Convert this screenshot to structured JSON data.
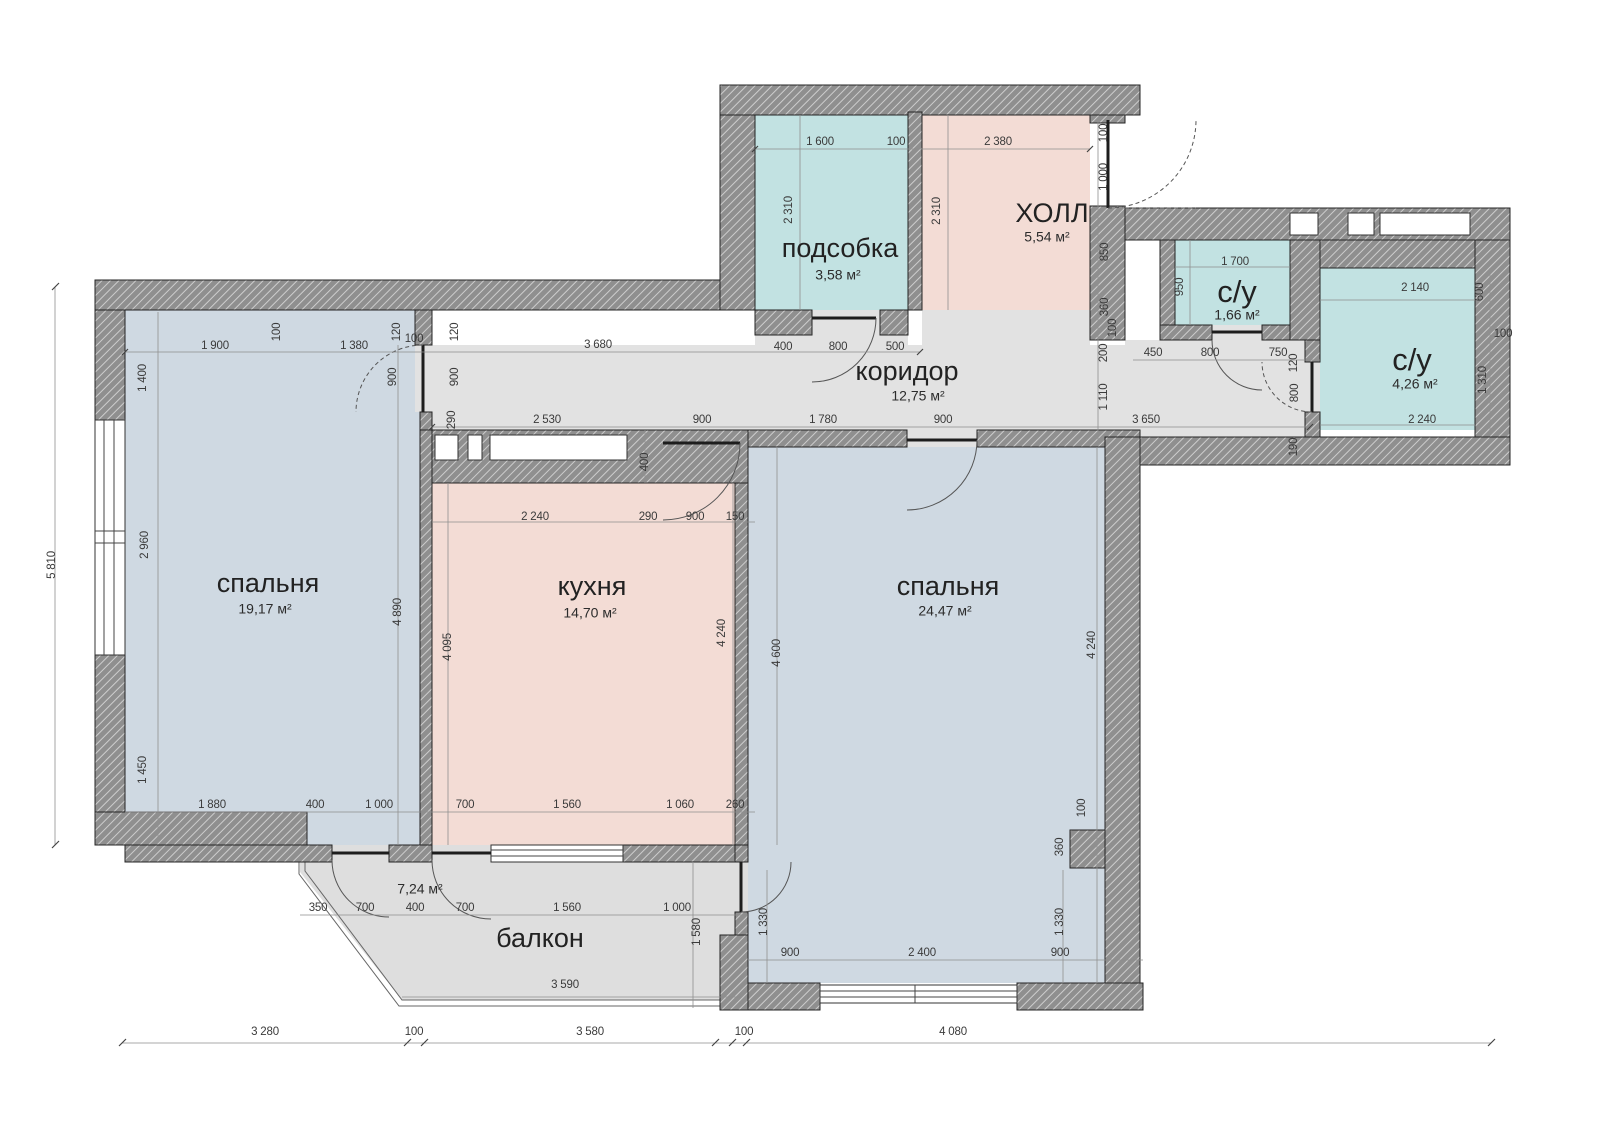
{
  "plan_title": "apartment-floor-plan",
  "colors": {
    "wall": "#8f8f8f",
    "room_blue": "#cfd9e2",
    "room_pink": "#f3dcd5",
    "room_teal": "#c2e2e2",
    "room_gray": "#e2e2e2",
    "balcony_gray": "#dedede"
  },
  "rooms": {
    "bedroom_left": {
      "name": "спальня",
      "area": "19,17 м²"
    },
    "kitchen": {
      "name": "кухня",
      "area": "14,70 м²"
    },
    "bedroom_right": {
      "name": "спальня",
      "area": "24,47 м²"
    },
    "corridor": {
      "name": "коридор",
      "area": "12,75 м²"
    },
    "utility": {
      "name": "подсобка",
      "area": "3,58 м²"
    },
    "hall": {
      "name": "ХОЛЛ",
      "area": "5,54 м²"
    },
    "bathroom_small": {
      "name": "с/у",
      "area": "1,66 м²"
    },
    "bathroom_large": {
      "name": "с/у",
      "area": "4,26 м²"
    },
    "balcony": {
      "name": "балкон",
      "area": "7,24 м²"
    }
  },
  "dimensions": [
    {
      "text": "1 600",
      "x": 820,
      "y": 142,
      "v": false
    },
    {
      "text": "100",
      "x": 896,
      "y": 142,
      "v": false
    },
    {
      "text": "2 380",
      "x": 998,
      "y": 142,
      "v": false
    },
    {
      "text": "2 310",
      "x": 789,
      "y": 210,
      "v": true
    },
    {
      "text": "2 310",
      "x": 937,
      "y": 211,
      "v": true
    },
    {
      "text": "100",
      "x": 1104,
      "y": 133,
      "v": true
    },
    {
      "text": "1 000",
      "x": 1104,
      "y": 177,
      "v": true
    },
    {
      "text": "850",
      "x": 1105,
      "y": 252,
      "v": true
    },
    {
      "text": "360",
      "x": 1105,
      "y": 307,
      "v": true
    },
    {
      "text": "100",
      "x": 1113,
      "y": 328,
      "v": true
    },
    {
      "text": "200",
      "x": 1104,
      "y": 353,
      "v": true
    },
    {
      "text": "1 110",
      "x": 1104,
      "y": 397,
      "v": true
    },
    {
      "text": "400",
      "x": 783,
      "y": 347,
      "v": false
    },
    {
      "text": "800",
      "x": 838,
      "y": 347,
      "v": false
    },
    {
      "text": "500",
      "x": 895,
      "y": 347,
      "v": false
    },
    {
      "text": "1 900",
      "x": 215,
      "y": 346,
      "v": false
    },
    {
      "text": "100",
      "x": 277,
      "y": 332,
      "v": true
    },
    {
      "text": "1 380",
      "x": 354,
      "y": 346,
      "v": false
    },
    {
      "text": "120",
      "x": 397,
      "y": 332,
      "v": true
    },
    {
      "text": "100",
      "x": 414,
      "y": 339,
      "v": false
    },
    {
      "text": "120",
      "x": 455,
      "y": 332,
      "v": true
    },
    {
      "text": "3 680",
      "x": 598,
      "y": 345,
      "v": false
    },
    {
      "text": "900",
      "x": 393,
      "y": 377,
      "v": true
    },
    {
      "text": "900",
      "x": 455,
      "y": 377,
      "v": true
    },
    {
      "text": "290",
      "x": 452,
      "y": 420,
      "v": true
    },
    {
      "text": "2 530",
      "x": 547,
      "y": 420,
      "v": false
    },
    {
      "text": "900",
      "x": 702,
      "y": 420,
      "v": false
    },
    {
      "text": "1 780",
      "x": 823,
      "y": 420,
      "v": false
    },
    {
      "text": "900",
      "x": 943,
      "y": 420,
      "v": false
    },
    {
      "text": "3 650",
      "x": 1146,
      "y": 420,
      "v": false
    },
    {
      "text": "450",
      "x": 1153,
      "y": 353,
      "v": false
    },
    {
      "text": "800",
      "x": 1210,
      "y": 353,
      "v": false
    },
    {
      "text": "750",
      "x": 1278,
      "y": 353,
      "v": false
    },
    {
      "text": "120",
      "x": 1294,
      "y": 363,
      "v": true
    },
    {
      "text": "800",
      "x": 1295,
      "y": 393,
      "v": true
    },
    {
      "text": "190",
      "x": 1294,
      "y": 447,
      "v": true
    },
    {
      "text": "1 700",
      "x": 1235,
      "y": 262,
      "v": false
    },
    {
      "text": "950",
      "x": 1180,
      "y": 287,
      "v": true
    },
    {
      "text": "2 140",
      "x": 1415,
      "y": 288,
      "v": false
    },
    {
      "text": "600",
      "x": 1480,
      "y": 292,
      "v": true
    },
    {
      "text": "100",
      "x": 1503,
      "y": 334,
      "v": false
    },
    {
      "text": "1 310",
      "x": 1483,
      "y": 380,
      "v": true
    },
    {
      "text": "2 240",
      "x": 1422,
      "y": 420,
      "v": false
    },
    {
      "text": "400",
      "x": 645,
      "y": 462,
      "v": true
    },
    {
      "text": "2 240",
      "x": 535,
      "y": 517,
      "v": false
    },
    {
      "text": "290",
      "x": 648,
      "y": 517,
      "v": false
    },
    {
      "text": "900",
      "x": 695,
      "y": 517,
      "v": false
    },
    {
      "text": "150",
      "x": 735,
      "y": 517,
      "v": false
    },
    {
      "text": "1 400",
      "x": 143,
      "y": 378,
      "v": true
    },
    {
      "text": "2 960",
      "x": 145,
      "y": 545,
      "v": true
    },
    {
      "text": "1 450",
      "x": 143,
      "y": 770,
      "v": true
    },
    {
      "text": "5 810",
      "x": 52,
      "y": 565,
      "v": true
    },
    {
      "text": "4 890",
      "x": 398,
      "y": 612,
      "v": true
    },
    {
      "text": "4 095",
      "x": 448,
      "y": 647,
      "v": true
    },
    {
      "text": "4 240",
      "x": 722,
      "y": 633,
      "v": true
    },
    {
      "text": "4 600",
      "x": 777,
      "y": 653,
      "v": true
    },
    {
      "text": "4 240",
      "x": 1092,
      "y": 645,
      "v": true
    },
    {
      "text": "1 880",
      "x": 212,
      "y": 805,
      "v": false
    },
    {
      "text": "400",
      "x": 315,
      "y": 805,
      "v": false
    },
    {
      "text": "1 000",
      "x": 379,
      "y": 805,
      "v": false
    },
    {
      "text": "700",
      "x": 465,
      "y": 805,
      "v": false
    },
    {
      "text": "1 560",
      "x": 567,
      "y": 805,
      "v": false
    },
    {
      "text": "1 060",
      "x": 680,
      "y": 805,
      "v": false
    },
    {
      "text": "260",
      "x": 735,
      "y": 805,
      "v": false
    },
    {
      "text": "100",
      "x": 1082,
      "y": 808,
      "v": true
    },
    {
      "text": "360",
      "x": 1060,
      "y": 847,
      "v": true
    },
    {
      "text": "350",
      "x": 318,
      "y": 908,
      "v": false
    },
    {
      "text": "700",
      "x": 365,
      "y": 908,
      "v": false
    },
    {
      "text": "400",
      "x": 415,
      "y": 908,
      "v": false
    },
    {
      "text": "700",
      "x": 465,
      "y": 908,
      "v": false
    },
    {
      "text": "1 560",
      "x": 567,
      "y": 908,
      "v": false
    },
    {
      "text": "1 000",
      "x": 677,
      "y": 908,
      "v": false
    },
    {
      "text": "1 580",
      "x": 697,
      "y": 932,
      "v": true
    },
    {
      "text": "1 330",
      "x": 764,
      "y": 922,
      "v": true
    },
    {
      "text": "900",
      "x": 790,
      "y": 953,
      "v": false
    },
    {
      "text": "2 400",
      "x": 922,
      "y": 953,
      "v": false
    },
    {
      "text": "900",
      "x": 1060,
      "y": 953,
      "v": false
    },
    {
      "text": "1 330",
      "x": 1060,
      "y": 922,
      "v": true
    },
    {
      "text": "3 590",
      "x": 565,
      "y": 985,
      "v": false
    },
    {
      "text": "3 280",
      "x": 265,
      "y": 1032,
      "v": false
    },
    {
      "text": "100",
      "x": 414,
      "y": 1032,
      "v": false
    },
    {
      "text": "3 580",
      "x": 590,
      "y": 1032,
      "v": false
    },
    {
      "text": "100",
      "x": 744,
      "y": 1032,
      "v": false
    },
    {
      "text": "4 080",
      "x": 953,
      "y": 1032,
      "v": false
    }
  ]
}
